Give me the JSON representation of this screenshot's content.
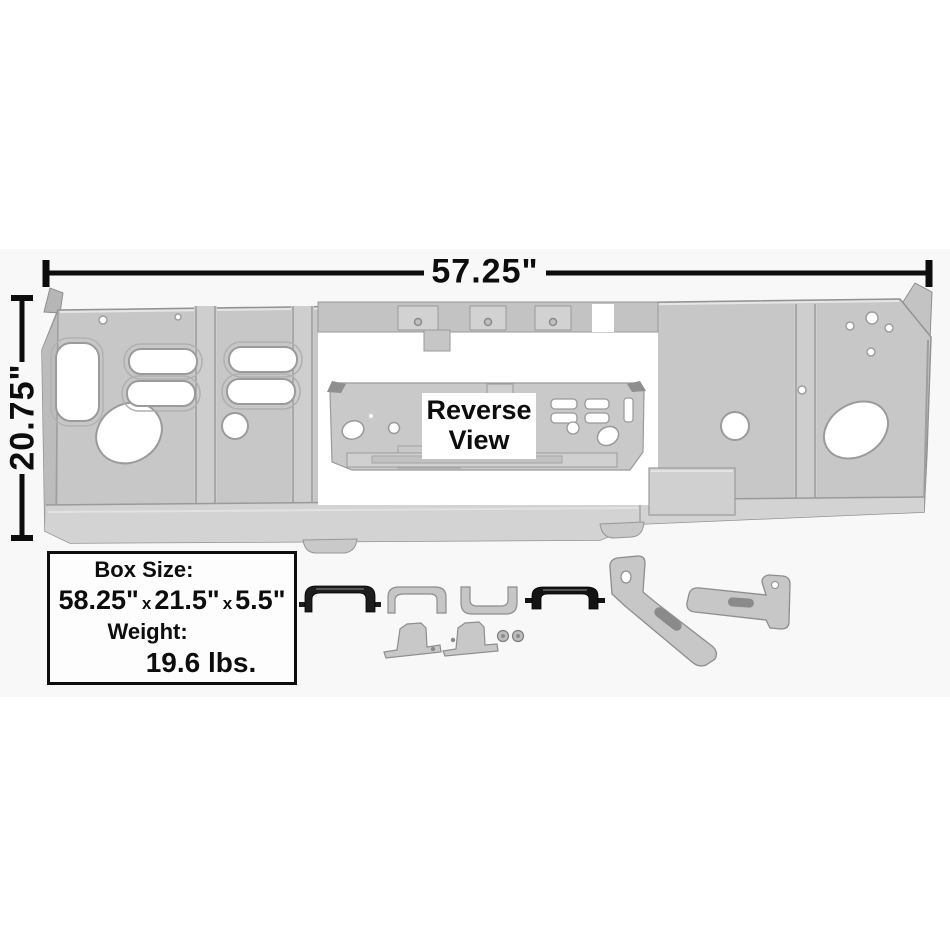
{
  "figure": {
    "width_dim": "57.25\"",
    "height_dim": "20.75\"",
    "reverse_view_label": "Reverse View"
  },
  "info_box": {
    "size_label": "Box Size:",
    "size_width": "58.25\"",
    "size_sep_1": "x",
    "size_depth": "21.5\"",
    "size_sep_2": "x",
    "size_height": "5.5\"",
    "weight_label": "Weight:",
    "weight_value": "19.6 lbs."
  },
  "colors": {
    "background": "#ffffff",
    "stage_band": "#f8f8f8",
    "panel_gray": "#c7c7c7",
    "panel_light": "#d2d2d2",
    "panel_edge": "#939393",
    "dimension_black": "#0d0d0d",
    "hardware_black": "#1d1d1d"
  }
}
